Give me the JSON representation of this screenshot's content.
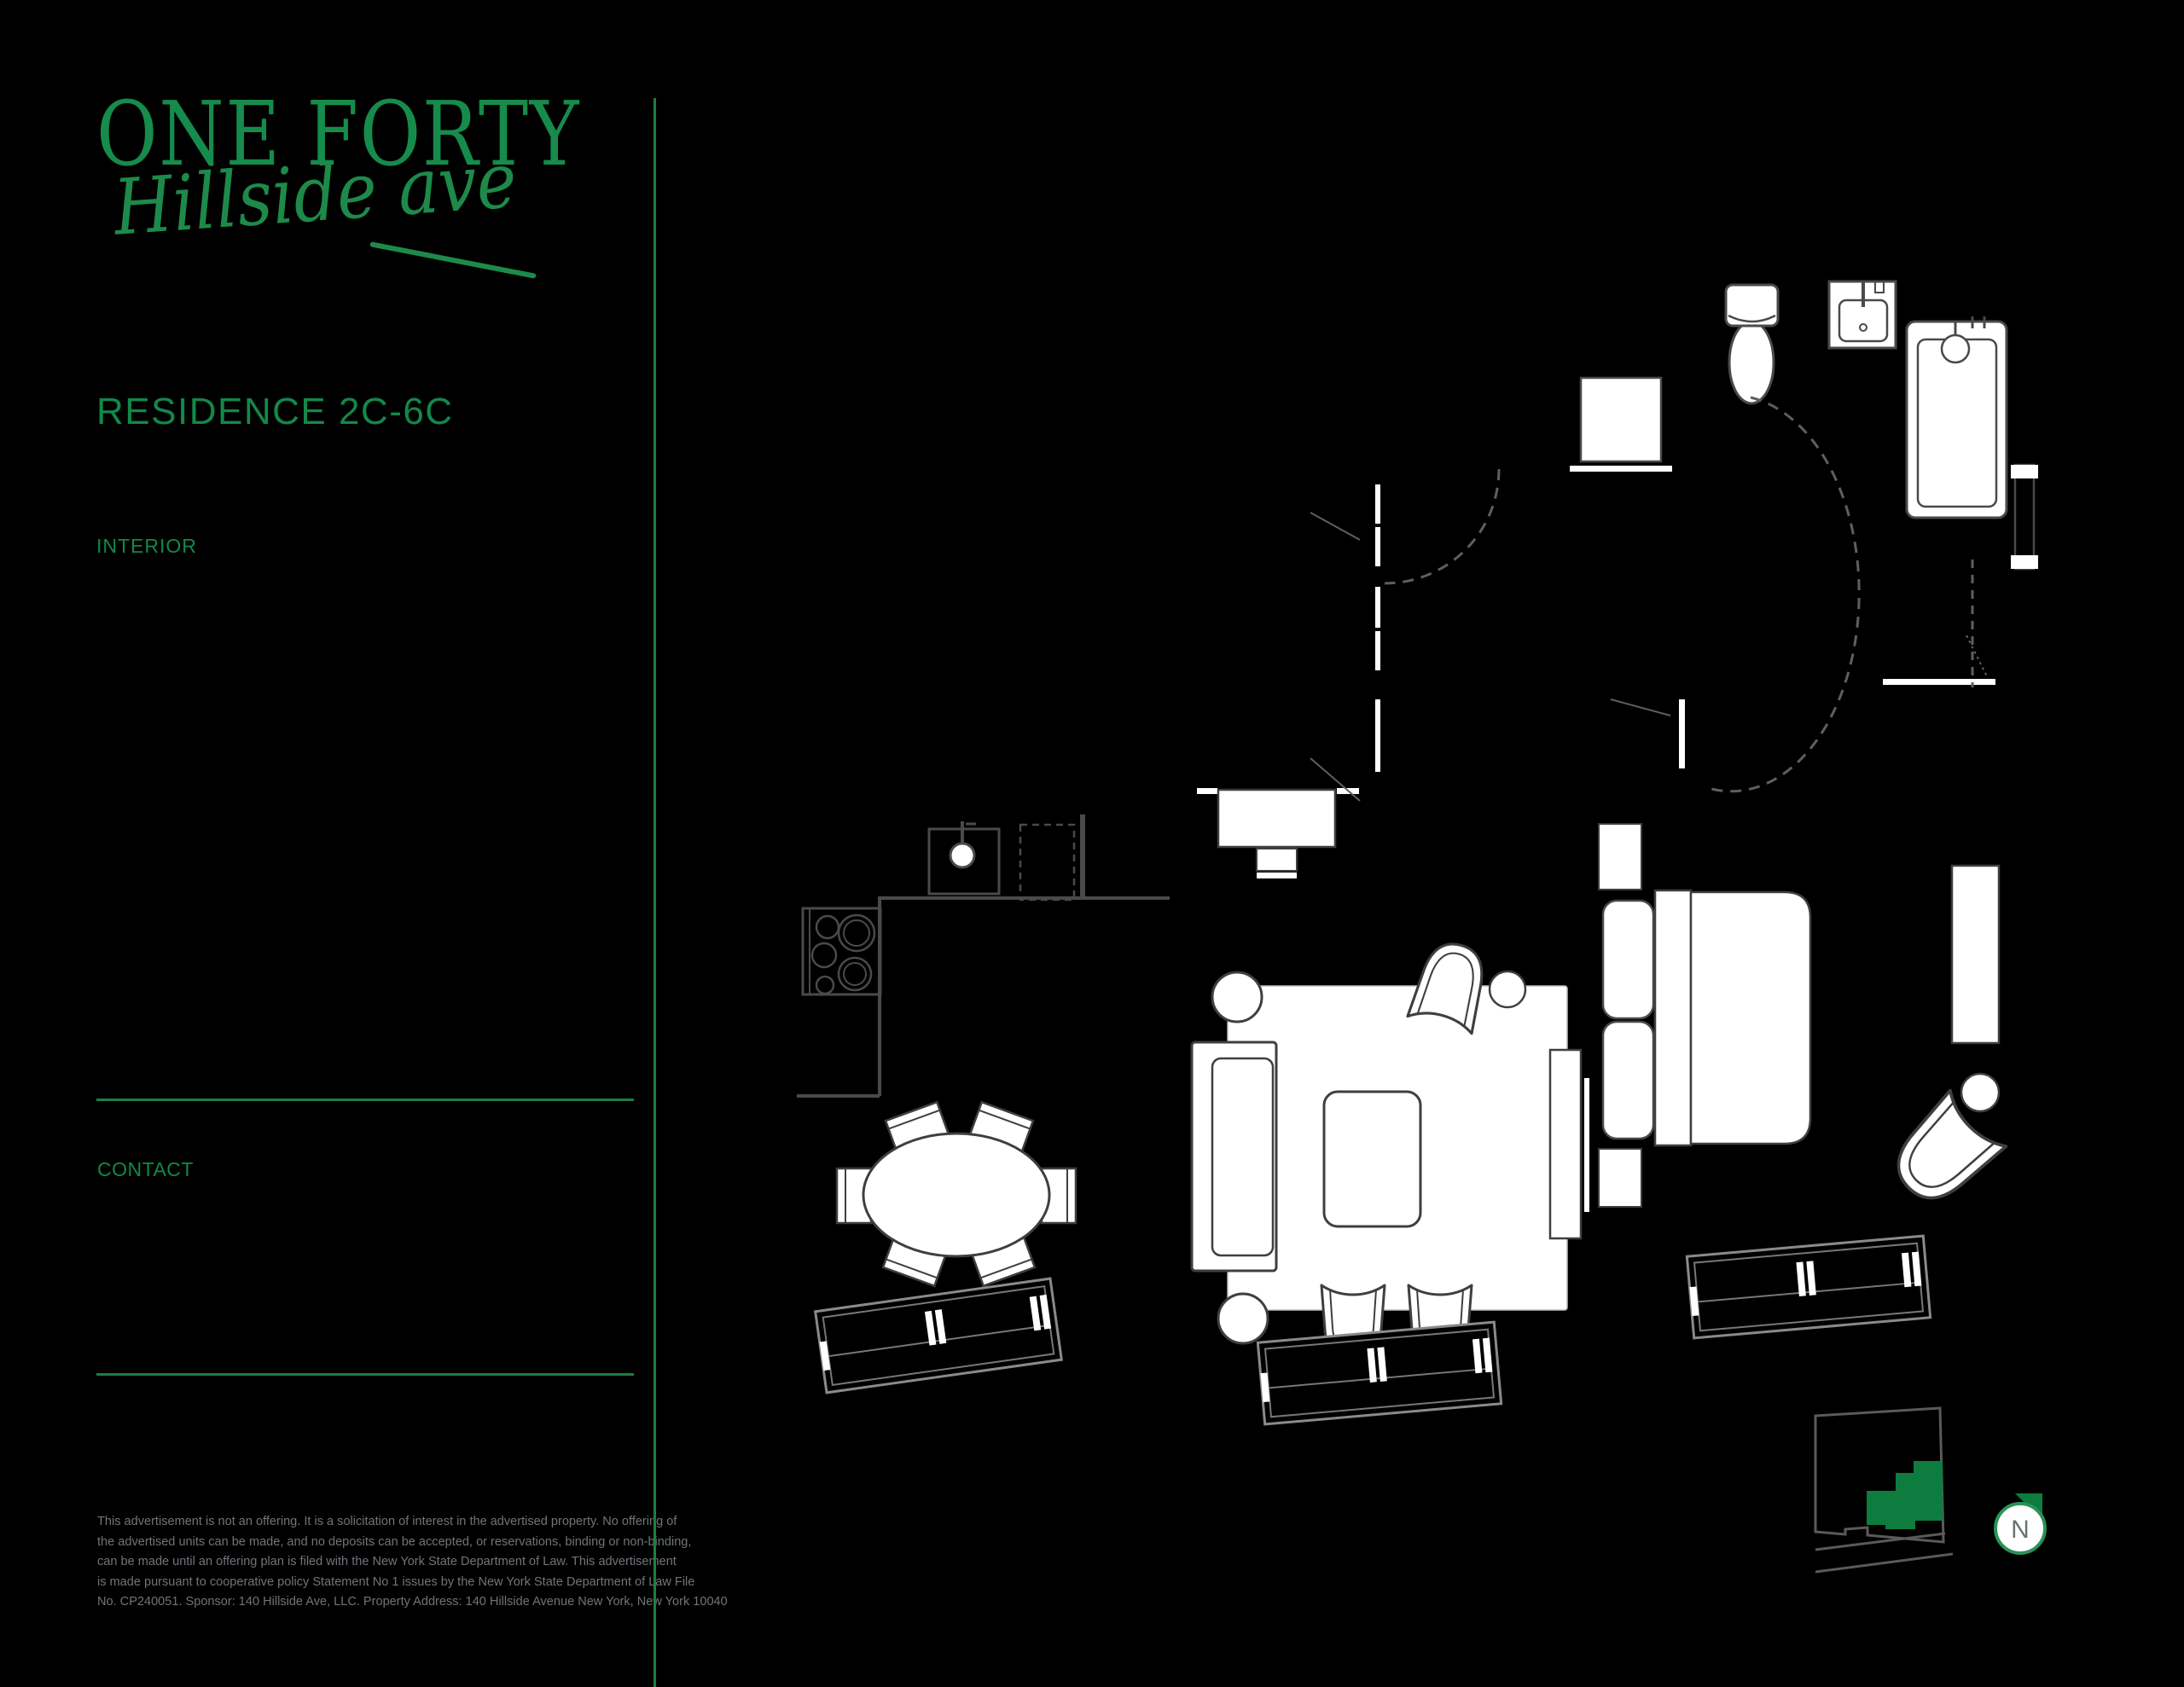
{
  "page": {
    "background": "#000000"
  },
  "brand": {
    "name": "ONE FORTY",
    "script": "Hillside ave",
    "green": "#168b4b"
  },
  "titles": {
    "residence": "RESIDENCE 2C-6C",
    "interior": "INTERIOR",
    "contact": "CONTACT"
  },
  "disclaimer": {
    "lines": [
      "This advertisement is not an offering. It is a solicitation of interest in the advertised property. No offering of",
      "the advertised units can be made, and no deposits can be accepted, or reservations, binding or non-binding,",
      "can be made until an offering plan is filed with the New York State Department of Law. This advertisement",
      "is made pursuant to cooperative policy Statement No 1 issues by the New York State Department of Law File",
      "No. CP240051. Sponsor: 140 Hillside Ave, LLC. Property Address: 140 Hillside Avenue New York, New York 10040"
    ]
  },
  "floor_plan": {
    "compass_label": "N"
  },
  "colors": {
    "brand_green": "#168b4b",
    "line_green": "#1c7f43",
    "keyplan_unit_green": "#0d7c3e",
    "compass_ring_green": "#2a9257",
    "disclaimer_gray": "#70747a",
    "fixture_gray": "#4a4a4a",
    "wall_white": "#ffffff",
    "background": "#000000"
  }
}
